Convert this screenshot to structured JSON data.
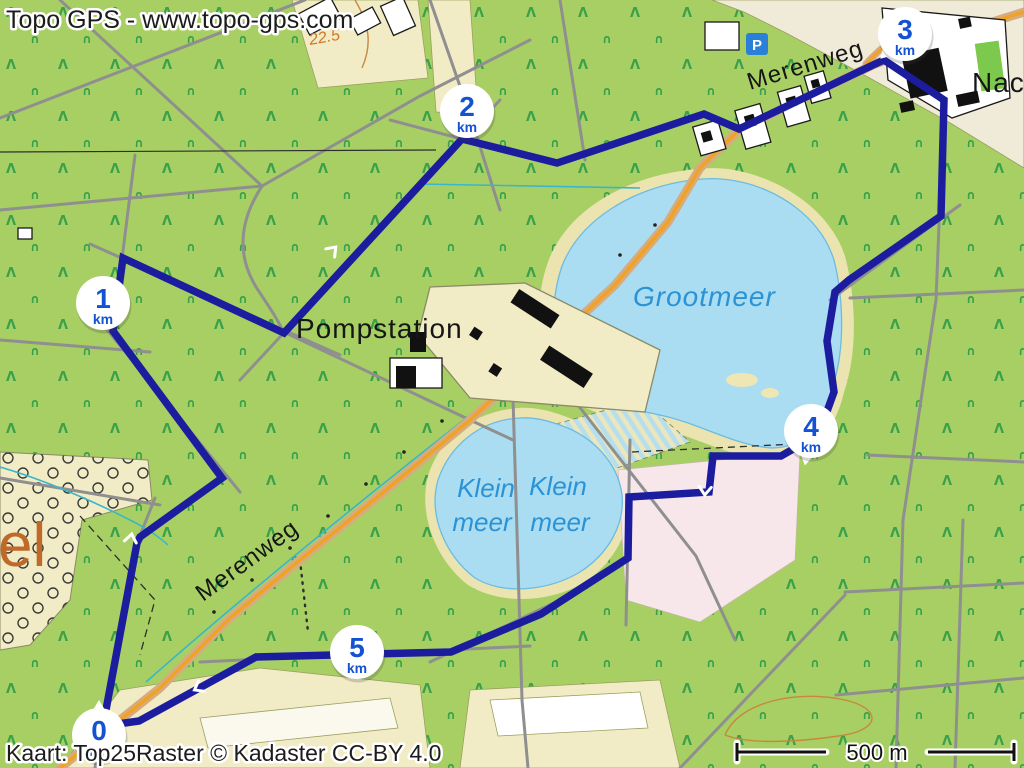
{
  "header": {
    "title": "Topo GPS - www.topo-gps.com"
  },
  "footer": {
    "attribution": "Kaart: Top25Raster © Kadaster CC-BY 4.0",
    "scale_label": "500 m"
  },
  "labels": {
    "road_top": "Merenweg",
    "road_bottom": "Merenweg",
    "lake_large": "Grootmeer",
    "lake_small_left": {
      "line1": "Klein",
      "line2": "meer"
    },
    "lake_small_right": {
      "line1": "Klein",
      "line2": "meer"
    },
    "pumping_station": "Pompstation",
    "place_left_partial": "el",
    "place_right_partial": "Nach",
    "elevation": "22.5",
    "parking": "P"
  },
  "route_markers": [
    {
      "value": "0",
      "unit": "km"
    },
    {
      "value": "1",
      "unit": "km"
    },
    {
      "value": "2",
      "unit": "km"
    },
    {
      "value": "3",
      "unit": "km"
    },
    {
      "value": "4",
      "unit": "km"
    },
    {
      "value": "5",
      "unit": "km"
    }
  ],
  "colors": {
    "route": "#1b1d9e",
    "marker_text": "#1452d4",
    "water": "#aadcf2",
    "water_label": "#2a93d5",
    "forest_background": "#a8cf63",
    "tree_symbol": "#2d9c48",
    "field_cream": "#f2ecc6",
    "heath_pink": "#f8e7ea",
    "road_orange": "#f0a223",
    "road_gray": "#8f8f8f",
    "contour_brown": "#c9873d",
    "place_label_orange": "#c06a2a",
    "parking_blue": "#2a7fd8"
  }
}
